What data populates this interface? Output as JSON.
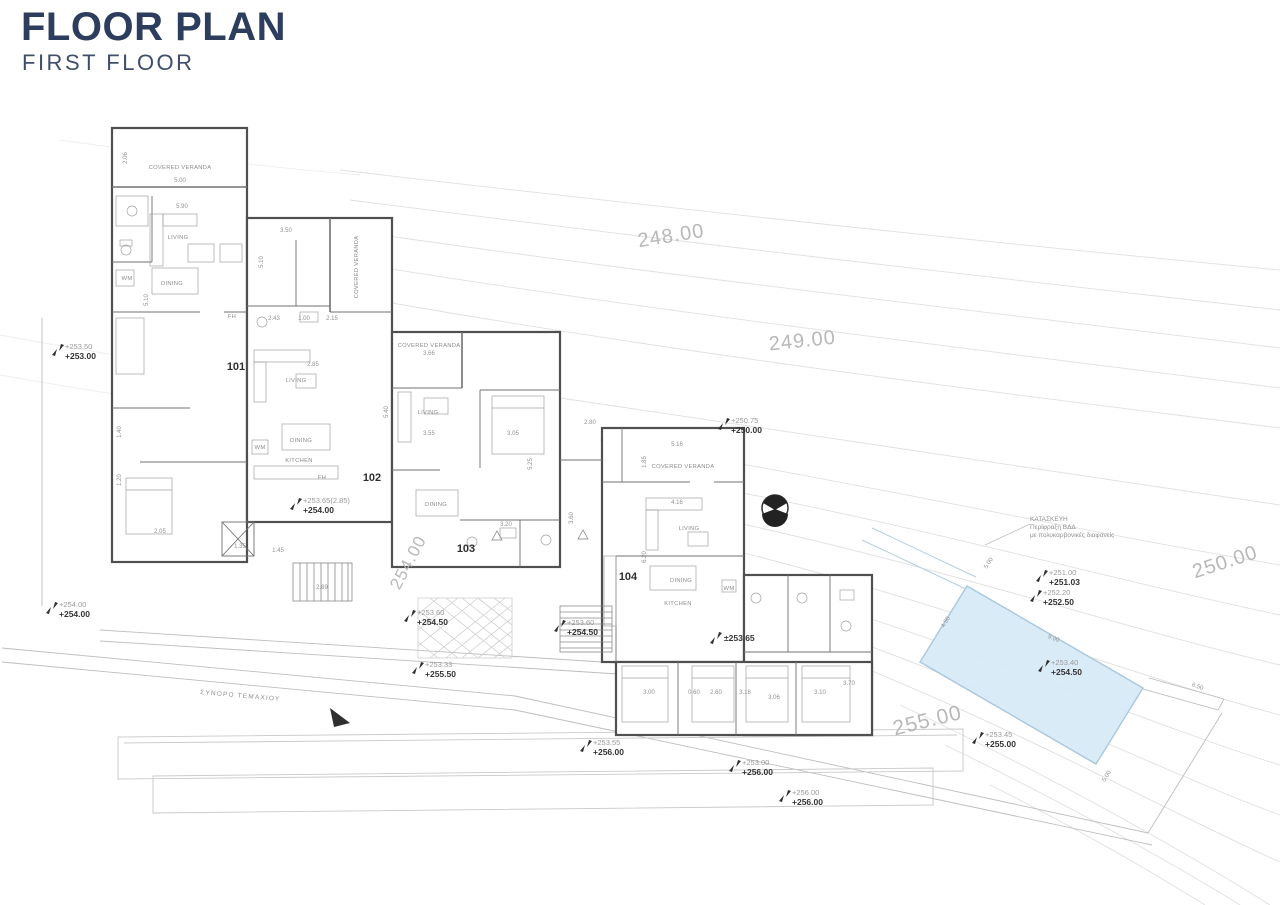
{
  "header": {
    "title": "FLOOR PLAN",
    "subtitle": "FIRST FLOOR"
  },
  "colors": {
    "title_navy": "#2d3d5e",
    "pool_fill": "#d6e9f7",
    "pool_border": "#a9c7dc",
    "contour_label_gray": "#b8b8b8",
    "wall_dark": "#4f4f4f",
    "site_line_gray": "#c4c4c4",
    "marker_text_dark": "#343434",
    "marker_text_light": "#9a9a9a"
  },
  "plan": {
    "contour_labels": [
      {
        "text": "248.00",
        "x": 672,
        "y": 242,
        "rot": -9,
        "size": 20
      },
      {
        "text": "249.00",
        "x": 803,
        "y": 347,
        "rot": -6,
        "size": 20
      },
      {
        "text": "250.00",
        "x": 1227,
        "y": 568,
        "rot": -18,
        "size": 20
      },
      {
        "text": "254.00",
        "x": 413,
        "y": 565,
        "rot": -62,
        "size": 17
      },
      {
        "text": "255.00",
        "x": 929,
        "y": 727,
        "rot": -14,
        "size": 21
      }
    ],
    "unit_labels": [
      {
        "text": "101",
        "x": 236,
        "y": 370
      },
      {
        "text": "102",
        "x": 372,
        "y": 481
      },
      {
        "text": "103",
        "x": 466,
        "y": 552
      },
      {
        "text": "104",
        "x": 628,
        "y": 580
      }
    ],
    "room_labels": [
      {
        "text": "COVERED VERANDA",
        "x": 180,
        "y": 169,
        "rot": 0
      },
      {
        "text": "LIVING",
        "x": 178,
        "y": 239,
        "rot": 0
      },
      {
        "text": "DINING",
        "x": 172,
        "y": 285,
        "rot": 0
      },
      {
        "text": "WM",
        "x": 127,
        "y": 280,
        "rot": 0
      },
      {
        "text": "FH",
        "x": 232,
        "y": 318,
        "rot": 0
      },
      {
        "text": "COVERED VERANDA",
        "x": 358,
        "y": 267,
        "rot": -90
      },
      {
        "text": "LIVING",
        "x": 296,
        "y": 382,
        "rot": 0
      },
      {
        "text": "DINING",
        "x": 301,
        "y": 442,
        "rot": 0
      },
      {
        "text": "KITCHEN",
        "x": 299,
        "y": 462,
        "rot": 0
      },
      {
        "text": "WM",
        "x": 260,
        "y": 449,
        "rot": 0
      },
      {
        "text": "FH",
        "x": 322,
        "y": 479,
        "rot": 0
      },
      {
        "text": "COVERED VERANDA",
        "x": 429,
        "y": 347,
        "rot": 0
      },
      {
        "text": "LIVING",
        "x": 428,
        "y": 414,
        "rot": 0
      },
      {
        "text": "DINING",
        "x": 436,
        "y": 506,
        "rot": 0
      },
      {
        "text": "COVERED VERANDA",
        "x": 683,
        "y": 468,
        "rot": 0
      },
      {
        "text": "LIVING",
        "x": 689,
        "y": 530,
        "rot": 0
      },
      {
        "text": "DINING",
        "x": 681,
        "y": 582,
        "rot": 0
      },
      {
        "text": "KITCHEN",
        "x": 678,
        "y": 605,
        "rot": 0
      },
      {
        "text": "WM",
        "x": 729,
        "y": 590,
        "rot": 0
      }
    ],
    "dimension_labels": [
      {
        "text": "2.06",
        "x": 127,
        "y": 158,
        "rot": -90
      },
      {
        "text": "5.00",
        "x": 180,
        "y": 182,
        "rot": 0
      },
      {
        "text": "5.90",
        "x": 182,
        "y": 208,
        "rot": 0
      },
      {
        "text": "5.10",
        "x": 148,
        "y": 300,
        "rot": -90
      },
      {
        "text": "1.40",
        "x": 121,
        "y": 432,
        "rot": -90
      },
      {
        "text": "1.20",
        "x": 121,
        "y": 480,
        "rot": -90
      },
      {
        "text": "2.05",
        "x": 160,
        "y": 533,
        "rot": 0
      },
      {
        "text": "1.35",
        "x": 240,
        "y": 548,
        "rot": 0
      },
      {
        "text": "1.45",
        "x": 278,
        "y": 552,
        "rot": 0
      },
      {
        "text": "2.89",
        "x": 322,
        "y": 589,
        "rot": 0
      },
      {
        "text": "3.50",
        "x": 286,
        "y": 232,
        "rot": 0
      },
      {
        "text": "5.10",
        "x": 263,
        "y": 262,
        "rot": -90
      },
      {
        "text": "2.43",
        "x": 274,
        "y": 320,
        "rot": 0
      },
      {
        "text": "1.00",
        "x": 304,
        "y": 320,
        "rot": 0
      },
      {
        "text": "2.15",
        "x": 332,
        "y": 320,
        "rot": 0
      },
      {
        "text": "2.85",
        "x": 313,
        "y": 366,
        "rot": 0
      },
      {
        "text": "5.40",
        "x": 388,
        "y": 412,
        "rot": -90
      },
      {
        "text": "3.66",
        "x": 429,
        "y": 355,
        "rot": 0
      },
      {
        "text": "3.55",
        "x": 429,
        "y": 435,
        "rot": 0
      },
      {
        "text": "3.05",
        "x": 513,
        "y": 435,
        "rot": 0
      },
      {
        "text": "5.25",
        "x": 532,
        "y": 464,
        "rot": -90
      },
      {
        "text": "3.20",
        "x": 506,
        "y": 526,
        "rot": 0
      },
      {
        "text": "3.60",
        "x": 573,
        "y": 518,
        "rot": -90
      },
      {
        "text": "2.80",
        "x": 590,
        "y": 424,
        "rot": 0
      },
      {
        "text": "5.16",
        "x": 677,
        "y": 446,
        "rot": 0
      },
      {
        "text": "1.85",
        "x": 646,
        "y": 462,
        "rot": -90
      },
      {
        "text": "4.16",
        "x": 677,
        "y": 504,
        "rot": 0
      },
      {
        "text": "6.20",
        "x": 646,
        "y": 557,
        "rot": -90
      },
      {
        "text": "3.00",
        "x": 649,
        "y": 694,
        "rot": 0
      },
      {
        "text": "0.60",
        "x": 694,
        "y": 694,
        "rot": 0
      },
      {
        "text": "2.60",
        "x": 716,
        "y": 694,
        "rot": 0
      },
      {
        "text": "3.18",
        "x": 745,
        "y": 694,
        "rot": 0
      },
      {
        "text": "3.06",
        "x": 774,
        "y": 699,
        "rot": 0
      },
      {
        "text": "3.10",
        "x": 820,
        "y": 694,
        "rot": 0
      },
      {
        "text": "3.70",
        "x": 849,
        "y": 685,
        "rot": 0
      },
      {
        "text": "5.00",
        "x": 990,
        "y": 564,
        "rot": -58
      },
      {
        "text": "4.50",
        "x": 947,
        "y": 623,
        "rot": -58
      },
      {
        "text": "9.00",
        "x": 1053,
        "y": 640,
        "rot": 20
      },
      {
        "text": "5.00",
        "x": 1108,
        "y": 777,
        "rot": -58
      },
      {
        "text": "6.50",
        "x": 1197,
        "y": 688,
        "rot": 20
      }
    ],
    "elevation_markers": [
      {
        "top": "+253.50",
        "bottom": "+253.00",
        "x": 58,
        "y": 350
      },
      {
        "top": "+254.00",
        "bottom": "+254.00",
        "x": 52,
        "y": 608
      },
      {
        "top": "+250.75",
        "bottom": "+250.00",
        "x": 724,
        "y": 424
      },
      {
        "top": "+253.65(2.85)",
        "bottom": "+254.00",
        "x": 296,
        "y": 504
      },
      {
        "top": "+253.60",
        "bottom": "+254.50",
        "x": 410,
        "y": 616
      },
      {
        "top": "+253.60",
        "bottom": "+254.50",
        "x": 560,
        "y": 626
      },
      {
        "top": "",
        "bottom": "±253.65",
        "x": 716,
        "y": 638
      },
      {
        "top": "+253.33",
        "bottom": "+255.50",
        "x": 418,
        "y": 668
      },
      {
        "top": "+253.55",
        "bottom": "+256.00",
        "x": 586,
        "y": 746
      },
      {
        "top": "+253.00",
        "bottom": "+256.00",
        "x": 735,
        "y": 766
      },
      {
        "top": "+256.00",
        "bottom": "+256.00",
        "x": 785,
        "y": 796
      },
      {
        "top": "+253.45",
        "bottom": "+255.00",
        "x": 978,
        "y": 738
      },
      {
        "top": "+251.00",
        "bottom": "+251.03",
        "x": 1042,
        "y": 576
      },
      {
        "top": "+252.20",
        "bottom": "+252.50",
        "x": 1036,
        "y": 596
      },
      {
        "top": "+253.40",
        "bottom": "+254.50",
        "x": 1044,
        "y": 666
      }
    ],
    "notes": [
      {
        "lines": [
          "ΚΑΤΑΣΚΕΥΗ",
          "Περίφραξη ΒΔΔ",
          "με πολυκαρβονικές διαφανείς"
        ],
        "x": 1030,
        "y": 521,
        "rot": 0
      },
      {
        "lines": [
          "ΣΥΝΟΡΟ ΤΕΜΑΧΙΟΥ"
        ],
        "x": 200,
        "y": 694,
        "rot": 5
      }
    ]
  }
}
